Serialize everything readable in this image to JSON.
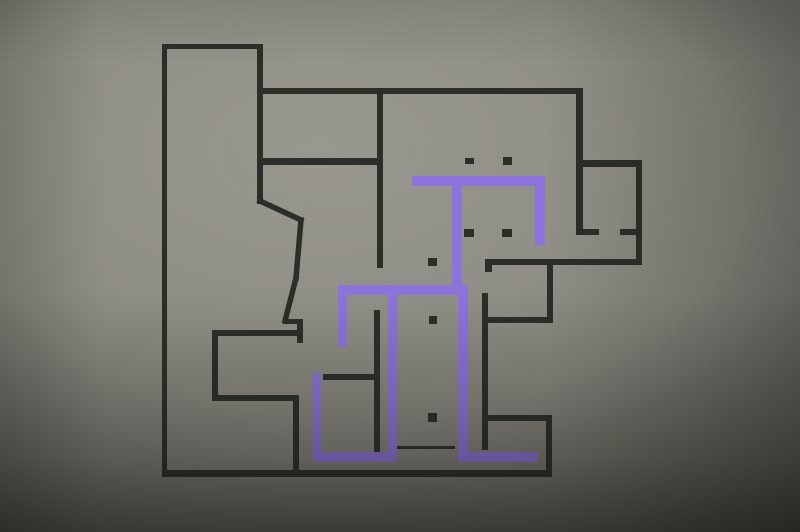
{
  "scene": {
    "description": "Photograph of a building floor plan painted on a gray wall; black wall outlines with a purple highlighted wayfinding route; no text or labels visible",
    "canvas": {
      "width": 800,
      "height": 532
    },
    "colors": {
      "background_light": "#9a9990",
      "background_mid": "#8e8d85",
      "background_dark": "#4b4a44",
      "wall_line": "#2a2c26",
      "route_purple": "#8d73de"
    }
  },
  "floorplan": {
    "walls": [
      {
        "name": "tower-top",
        "x": 162,
        "y": 44,
        "w": 101,
        "h": 5
      },
      {
        "name": "outer-left-wall",
        "x": 162,
        "y": 44,
        "w": 5,
        "h": 433
      },
      {
        "name": "tower-right-wall",
        "x": 257,
        "y": 44,
        "w": 6,
        "h": 160
      },
      {
        "name": "top-main-wall",
        "x": 257,
        "y": 88,
        "w": 325,
        "h": 6
      },
      {
        "name": "mid-left-horizontal",
        "x": 257,
        "y": 158,
        "w": 126,
        "h": 7
      },
      {
        "name": "center-vertical-upper",
        "x": 377,
        "y": 88,
        "w": 6,
        "h": 180
      },
      {
        "name": "topright-room-left",
        "x": 576,
        "y": 88,
        "w": 7,
        "h": 147
      },
      {
        "name": "topright-room-top",
        "x": 576,
        "y": 160,
        "w": 66,
        "h": 7
      },
      {
        "name": "topright-room-right",
        "x": 636,
        "y": 160,
        "w": 6,
        "h": 105
      },
      {
        "name": "door-wall-left-seg",
        "x": 578,
        "y": 229,
        "w": 21,
        "h": 6
      },
      {
        "name": "door-wall-right-seg",
        "x": 620,
        "y": 229,
        "w": 18,
        "h": 6
      },
      {
        "name": "long-horizontal",
        "x": 485,
        "y": 259,
        "w": 157,
        "h": 6
      },
      {
        "name": "long-horizontal-tick",
        "x": 485,
        "y": 259,
        "w": 7,
        "h": 13
      },
      {
        "name": "stub-vertical",
        "x": 547,
        "y": 259,
        "w": 6,
        "h": 64
      },
      {
        "name": "horizontal-317",
        "x": 485,
        "y": 317,
        "w": 68,
        "h": 6
      },
      {
        "name": "right-inner-vertical",
        "x": 482,
        "y": 293,
        "w": 6,
        "h": 157
      },
      {
        "name": "horizontal-415",
        "x": 485,
        "y": 415,
        "w": 67,
        "h": 6
      },
      {
        "name": "bottomright-vertical",
        "x": 546,
        "y": 415,
        "w": 6,
        "h": 58
      },
      {
        "name": "bottom-wall",
        "x": 162,
        "y": 470,
        "w": 390,
        "h": 7
      },
      {
        "name": "bottomleft-right-v",
        "x": 293,
        "y": 395,
        "w": 6,
        "h": 77
      },
      {
        "name": "bottomleft-bottom-h",
        "x": 212,
        "y": 395,
        "w": 87,
        "h": 6
      },
      {
        "name": "bottomleft-left-v",
        "x": 212,
        "y": 330,
        "w": 6,
        "h": 71
      },
      {
        "name": "bottomleft-top-h",
        "x": 212,
        "y": 330,
        "w": 90,
        "h": 6
      },
      {
        "name": "notch-vertical",
        "x": 297,
        "y": 319,
        "w": 6,
        "h": 24
      },
      {
        "name": "notch-horizontal",
        "x": 283,
        "y": 319,
        "w": 20,
        "h": 5
      },
      {
        "name": "center-vertical-lower",
        "x": 374,
        "y": 310,
        "w": 6,
        "h": 142
      },
      {
        "name": "horizontal-374",
        "x": 323,
        "y": 374,
        "w": 57,
        "h": 6
      }
    ],
    "diagonal_walls": [
      {
        "name": "notch-diagonal-upper",
        "x1": 260,
        "y1": 201,
        "x2": 301,
        "y2": 220
      },
      {
        "name": "notch-vertical-leaning",
        "x1": 301,
        "y1": 220,
        "x2": 296,
        "y2": 278
      },
      {
        "name": "notch-diagonal-lower",
        "x1": 296,
        "y1": 278,
        "x2": 285,
        "y2": 321
      }
    ],
    "door_dashes": [
      {
        "name": "dash-row1-left",
        "x": 465,
        "y": 158,
        "w": 9,
        "h": 6
      },
      {
        "name": "dash-row1-right",
        "x": 503,
        "y": 157,
        "w": 9,
        "h": 8
      },
      {
        "name": "dash-row2-left",
        "x": 464,
        "y": 229,
        "w": 10,
        "h": 8
      },
      {
        "name": "dash-row2-right",
        "x": 502,
        "y": 229,
        "w": 10,
        "h": 8
      }
    ],
    "corridor_dots": [
      {
        "name": "corridor-dot-top",
        "x": 428,
        "y": 258,
        "w": 9,
        "h": 8
      },
      {
        "name": "corridor-dot-middle",
        "x": 429,
        "y": 316,
        "w": 8,
        "h": 8
      },
      {
        "name": "corridor-dot-bottom",
        "x": 428,
        "y": 413,
        "w": 9,
        "h": 9
      }
    ],
    "thin_lines": [
      {
        "name": "threshold-line",
        "x": 397,
        "y": 446,
        "w": 58,
        "h": 3
      }
    ],
    "route_segments": [
      {
        "name": "route-top-bar",
        "x": 412,
        "y": 176,
        "w": 133,
        "h": 10
      },
      {
        "name": "route-top-right-drop",
        "x": 535,
        "y": 176,
        "w": 10,
        "h": 69
      },
      {
        "name": "route-top-stem",
        "x": 452,
        "y": 176,
        "w": 10,
        "h": 118
      },
      {
        "name": "route-mid-horizontal",
        "x": 338,
        "y": 285,
        "w": 130,
        "h": 10
      },
      {
        "name": "route-left-stub",
        "x": 338,
        "y": 285,
        "w": 9,
        "h": 62
      },
      {
        "name": "route-u-right-arm",
        "x": 388,
        "y": 294,
        "w": 9,
        "h": 168
      },
      {
        "name": "route-u-bottom",
        "x": 313,
        "y": 452,
        "w": 84,
        "h": 10
      },
      {
        "name": "route-u-left-arm",
        "x": 313,
        "y": 373,
        "w": 8,
        "h": 89
      },
      {
        "name": "route-right-corridor",
        "x": 458,
        "y": 294,
        "w": 10,
        "h": 168
      },
      {
        "name": "route-bottom-right-h",
        "x": 458,
        "y": 452,
        "w": 80,
        "h": 10
      }
    ]
  }
}
